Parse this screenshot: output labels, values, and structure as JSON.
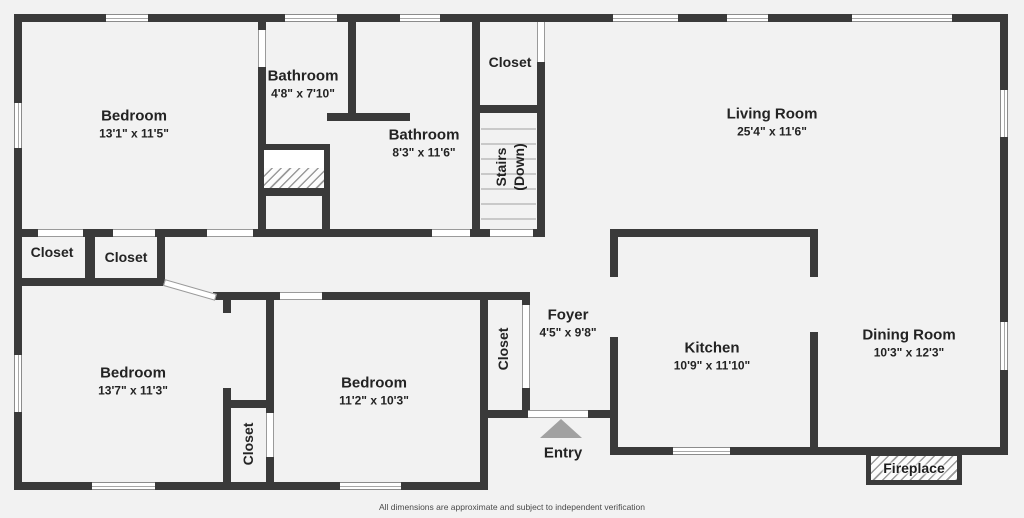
{
  "plan": {
    "rooms": [
      {
        "id": "bedroom-1",
        "name": "Bedroom",
        "dims": "13'1\" x 11'5\""
      },
      {
        "id": "bathroom-1",
        "name": "Bathroom",
        "dims": "4'8\" x 7'10\""
      },
      {
        "id": "bathroom-2",
        "name": "Bathroom",
        "dims": "8'3\" x 11'6\""
      },
      {
        "id": "living-room",
        "name": "Living Room",
        "dims": "25'4\" x 11'6\""
      },
      {
        "id": "foyer",
        "name": "Foyer",
        "dims": "4'5\" x 9'8\""
      },
      {
        "id": "kitchen",
        "name": "Kitchen",
        "dims": "10'9\" x 11'10\""
      },
      {
        "id": "dining-room",
        "name": "Dining Room",
        "dims": "10'3\" x 12'3\""
      },
      {
        "id": "bedroom-2",
        "name": "Bedroom",
        "dims": "13'7\" x 11'3\""
      },
      {
        "id": "bedroom-3",
        "name": "Bedroom",
        "dims": "11'2\" x 10'3\""
      }
    ],
    "labels": {
      "closet_top": "Closet",
      "closet_1": "Closet",
      "closet_2": "Closet",
      "closet_mid": "Closet",
      "closet_foyer": "Closet",
      "stairs_line1": "Stairs",
      "stairs_line2": "(Down)",
      "entry": "Entry",
      "fireplace": "Fireplace"
    },
    "disclaimer": "All dimensions are approximate and subject to independent verification",
    "colors": {
      "wall": "#3a3a3a",
      "background": "#f2f2f2",
      "entry_arrow": "#a1a1a1"
    }
  }
}
